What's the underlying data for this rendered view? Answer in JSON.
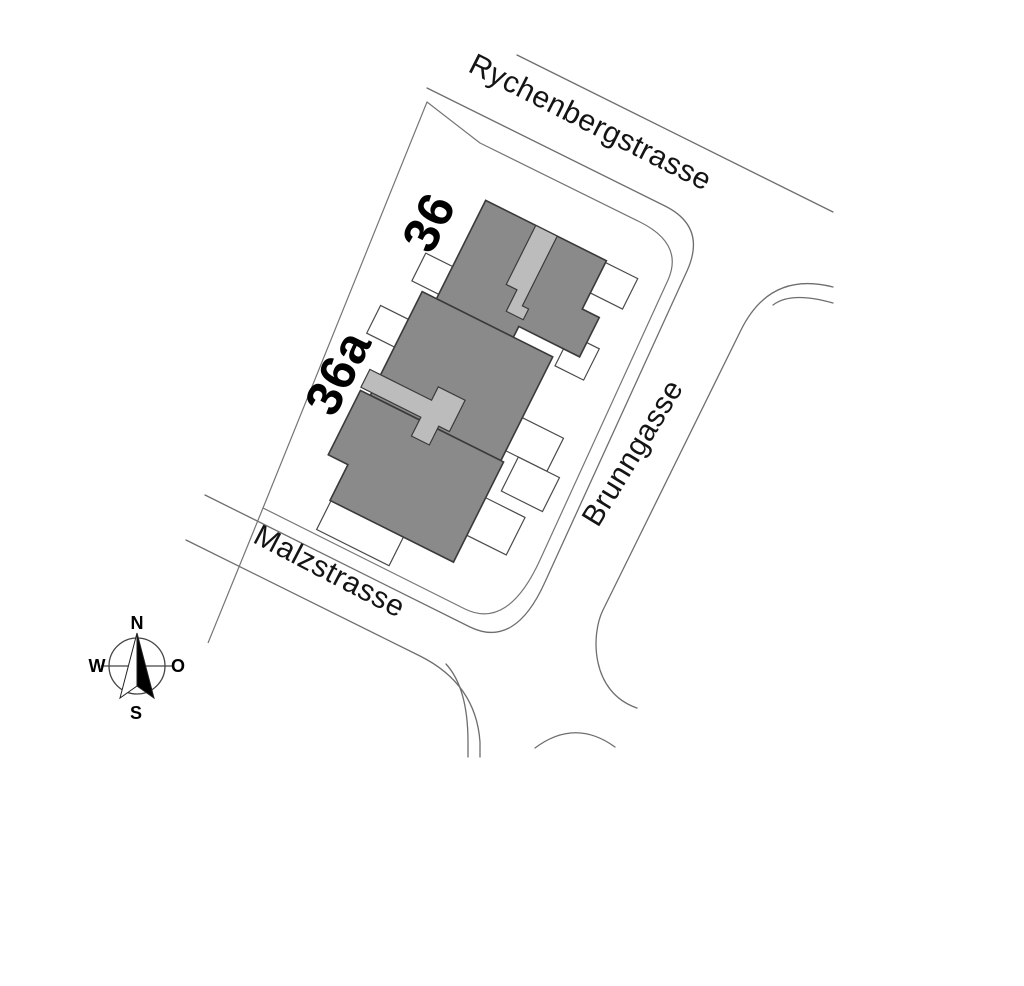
{
  "plan": {
    "streets": {
      "north_label": "Rychenbergstrasse",
      "east_label": "Brunngasse",
      "south_label": "Malzstrasse"
    },
    "buildings": {
      "b36_label": "36",
      "b36a_label": "36a"
    },
    "compass": {
      "north": "N",
      "east": "O",
      "south": "S",
      "west": "W"
    }
  },
  "colors": {
    "building_fill": "#8a8a8a",
    "stairwell_fill": "#bcbcbc",
    "building_stroke": "#3a3a3a",
    "annex_fill": "#ffffff",
    "annex_stroke": "#4a4a4a",
    "street_line": "#6e6e6e",
    "label_text": "#111111"
  }
}
